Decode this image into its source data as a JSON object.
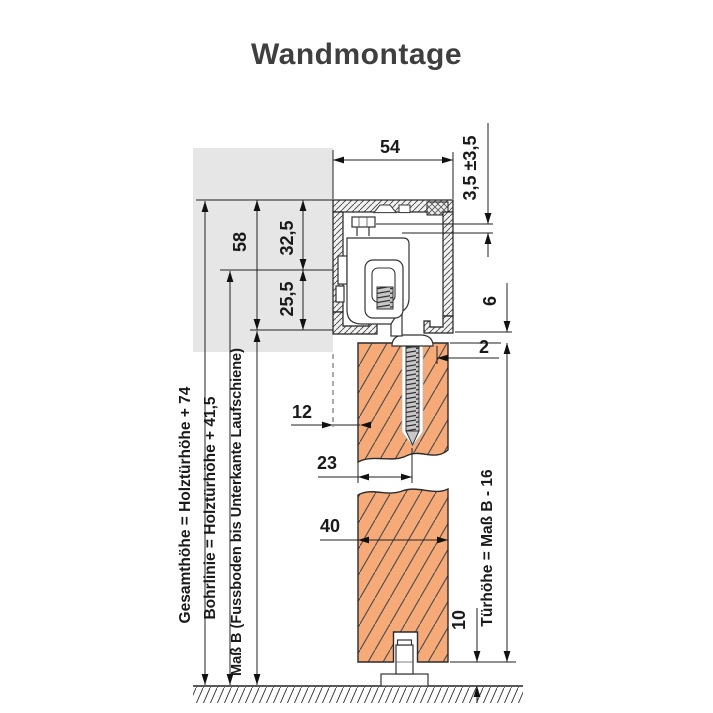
{
  "title": "Wandmontage",
  "colors": {
    "door_fill": "#F5AA78",
    "wall_fill": "#E6E6E6",
    "line": "#222222",
    "title_text": "#3F3F3F"
  },
  "dimensions": {
    "track_width": "54",
    "height_adjust": "3,5 ±3,5",
    "track_height": "58",
    "top_to_bohrlinie": "32,5",
    "bohrlinie_to_bottom": "25,5",
    "track_to_door_gap": "6",
    "gap_2": "2",
    "wall_to_door": "12",
    "door_face_to_screw": "23",
    "door_thickness": "40",
    "floor_gap": "10"
  },
  "labels": {
    "gesamthoehe": "Gesamthöhe = Holztürhöhe + 74",
    "bohrlinie": "Bohrlinie = Holztürhöhe + 41,5",
    "mass_b": "Maß B (Fussboden bis Unterkante Laufschiene)",
    "tuerhoehe": "Türhöhe = Maß B - 16"
  }
}
